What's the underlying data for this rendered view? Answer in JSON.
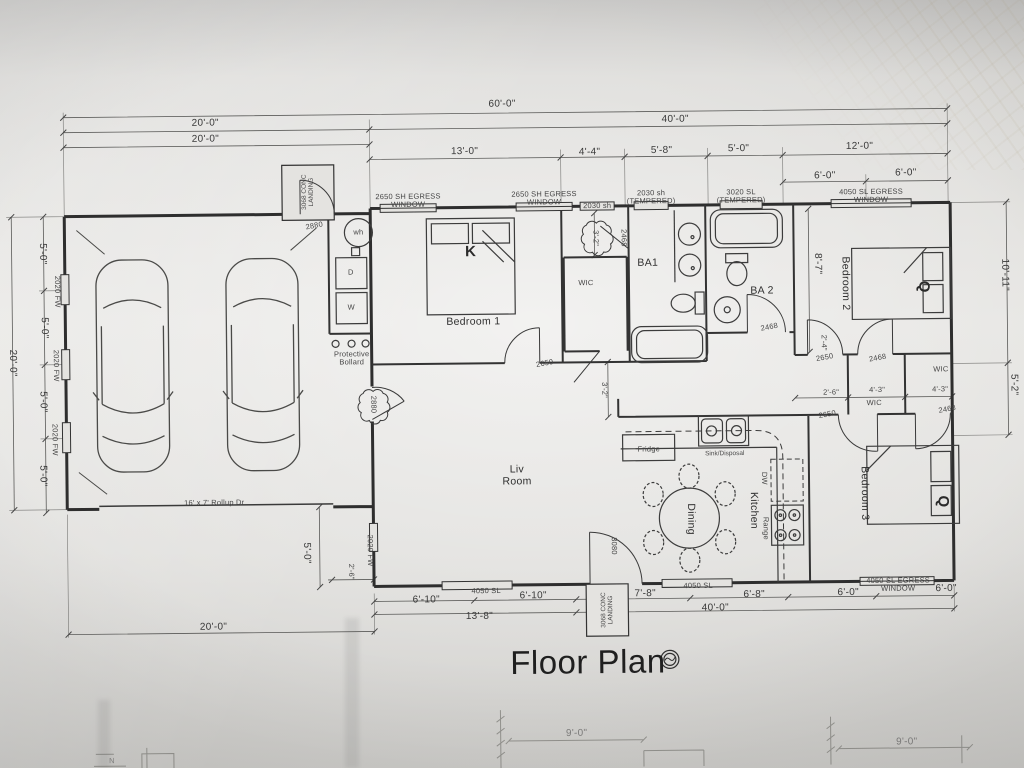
{
  "title": "Floor Plan",
  "dims": {
    "ft60": "60'-0\"",
    "ft40": "40'-0\"",
    "ft20": "20'-0\"",
    "ft13": "13'-0\"",
    "ft4_4": "4'-4\"",
    "ft5_8": "5'-8\"",
    "ft5_0": "5'-0\"",
    "ft12": "12'-0\"",
    "ft6": "6'-0\"",
    "ft6_10": "6'-10\"",
    "ft13_8": "13'-8\"",
    "ft7_8": "7'-8\"",
    "ft6_8": "6'-8\"",
    "ft10_11": "10'-11\"",
    "ft8_7": "8'-7\"",
    "ft5_2": "5'-2\"",
    "ft4_3": "4'-3\"",
    "ft3_2": "3'-2\"",
    "ft2_6": "2'-6\"",
    "ft2_4": "2'-4\"",
    "ft9": "9'-0\""
  },
  "windows": {
    "fw2020": "2020 FW",
    "egress2650": "2650 SH EGRESS WINDOW",
    "sh2030": "2030 sh",
    "sh2030_tempered": "2030 sh (TEMPERED)",
    "sl3020_tempered": "3020 SL (TEMPERED)",
    "egress4050": "4050 SL EGRESS WINDOW",
    "sl4050": "4050 SL"
  },
  "doors": {
    "conc_landing": "3068 CONC LANDING",
    "d2880": "2880",
    "d2650": "2650",
    "d2468": "2468",
    "d3080": "3080",
    "rollup": "16' x 7' Rollup Dr"
  },
  "rooms": {
    "bedroom1": "Bedroom 1",
    "bedroom2": "Bedroom 2",
    "bedroom3": "Bedroom 3",
    "living": "Liv Room",
    "dining": "Dining",
    "kitchen": "Kitchen",
    "wic": "WIC",
    "ba1": "BA1",
    "ba2": "BA 2"
  },
  "fixtures": {
    "bed_king": "K",
    "bed_queen": "Q",
    "washer": "W",
    "dryer": "D",
    "water_heater": "wh",
    "fridge": "Fridge",
    "sink_disposal": "Sink/Disposal",
    "dishwasher": "DW",
    "range": "Range",
    "bollard": "Protective Bollard"
  },
  "footer": {
    "north": "N"
  }
}
